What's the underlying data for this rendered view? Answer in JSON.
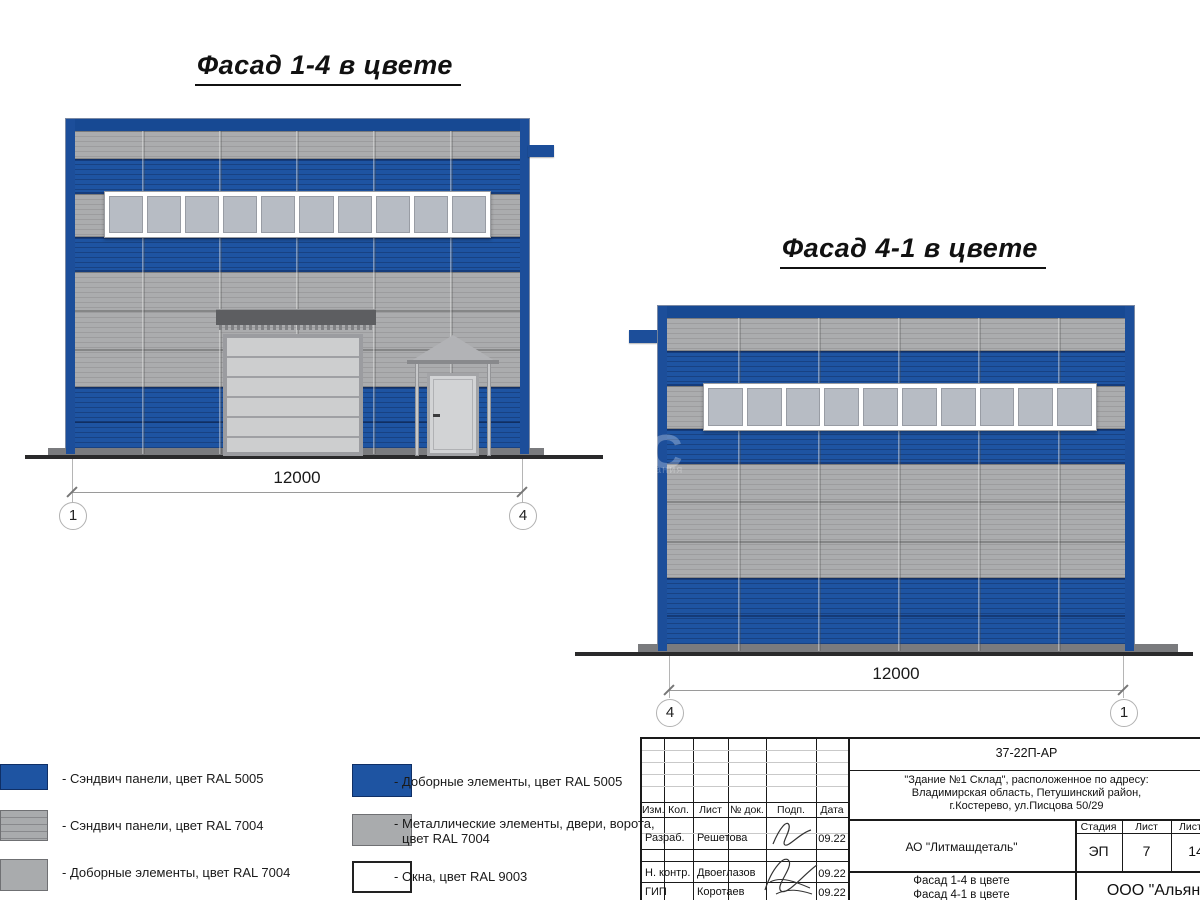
{
  "titles": {
    "facade_1_4": "Фасад 1-4 в цвете",
    "facade_4_1": "Фасад 4-1 в цвете"
  },
  "facade_1_4": {
    "dimension": "12000",
    "axis_left": "1",
    "axis_right": "4",
    "window_count": 10
  },
  "facade_4_1": {
    "dimension": "12000",
    "axis_left": "4",
    "axis_right": "1",
    "window_count": 10
  },
  "watermark": {
    "big": "С",
    "small": "ания"
  },
  "legend": {
    "left": [
      {
        "swatch": "blue-panel",
        "label": "- Сэндвич панели, цвет RAL 5005"
      },
      {
        "swatch": "gray-striped-panel",
        "label": "- Сэндвич панели, цвет RAL 7004"
      },
      {
        "swatch": "gray-panel",
        "label": "- Доборные элементы, цвет RAL 7004"
      }
    ],
    "right": [
      {
        "swatch": "blue-panel",
        "label": "- Доборные элементы, цвет RAL 5005"
      },
      {
        "swatch": "gray-panel",
        "label_line1": "- Металлические элементы, двери, ворота,",
        "label_line2": "цвет RAL 7004"
      },
      {
        "swatch": "white-panel",
        "label": "- Окна, цвет RAL 9003"
      }
    ]
  },
  "title_block": {
    "doc_number": "37-22П-АР",
    "address_line1": "\"Здание №1 Склад\", расположенное по адресу:",
    "address_line2": "Владимирская область, Петушинский район,",
    "address_line3": "г.Костерево, ул.Писцова 50/29",
    "customer": "АО \"Литмашдеталь\"",
    "sheet_title_line1": "Фасад 1-4 в цвете",
    "sheet_title_line2": "Фасад 4-1 в цвете",
    "company": "ООО \"Альянс",
    "columns": {
      "izm": "Изм.",
      "kol": "Кол.",
      "list": "Лист",
      "doc": "№ док.",
      "podp": "Подп.",
      "data": "Дата"
    },
    "stage_label": "Стадия",
    "sheet_label": "Лист",
    "sheets_label": "Листов",
    "stage_value": "ЭП",
    "sheet_value": "7",
    "sheets_value": "14",
    "rows": [
      {
        "role": "Разраб.",
        "name": "Решетова",
        "date": "09.22"
      },
      {
        "role": "Н. контр.",
        "name": "Двоеглазов",
        "date": "09.22"
      },
      {
        "role": "ГИП",
        "name": "Коротаев",
        "date": "09.22"
      }
    ]
  },
  "colors": {
    "ral5005_blue": "#1e54a2",
    "ral5005_frame": "#174993",
    "ral7004_gray": "#abacae",
    "ral9003_white": "#ffffff",
    "window_glass": "#b7bcc4",
    "ground": "#2a2a2b"
  }
}
